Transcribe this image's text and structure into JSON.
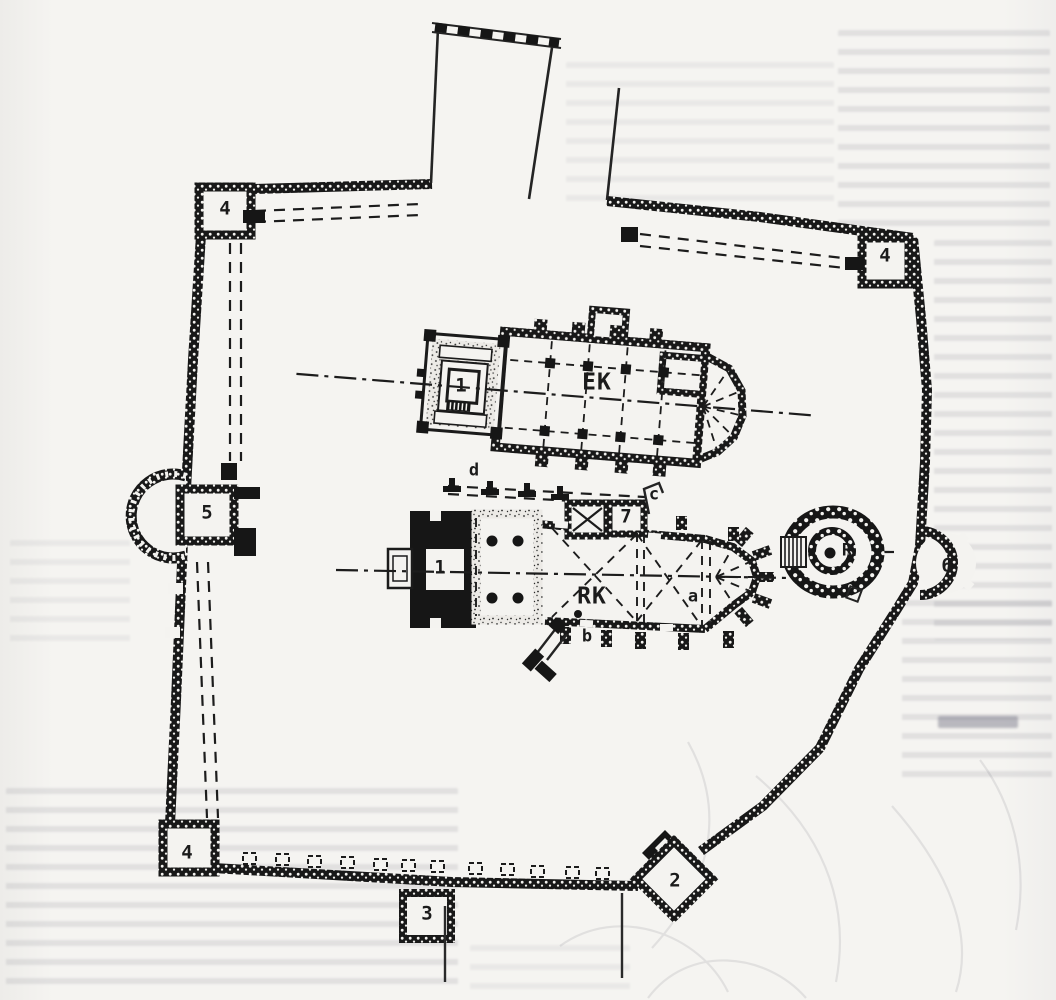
{
  "page": {
    "figure_type": "ground-plan",
    "paper_color": "#f4f3f0",
    "ink_color": "#1b1b1b"
  },
  "plan": {
    "labels": {
      "upper_church": "EK",
      "lower_church": "RK",
      "rotunda": "R",
      "upper_westwork": "1",
      "lower_westwork": "1",
      "southeast_gate_tower": "2",
      "south_tower": "3",
      "northwest_tower": "4",
      "northeast_tower": "4",
      "southwest_tower": "4",
      "west_gate": "5",
      "east_bastion": "6",
      "north_chapel": "7",
      "annotation_a": "a",
      "annotation_b": "b",
      "annotation_c": "c",
      "annotation_d": "d"
    }
  }
}
